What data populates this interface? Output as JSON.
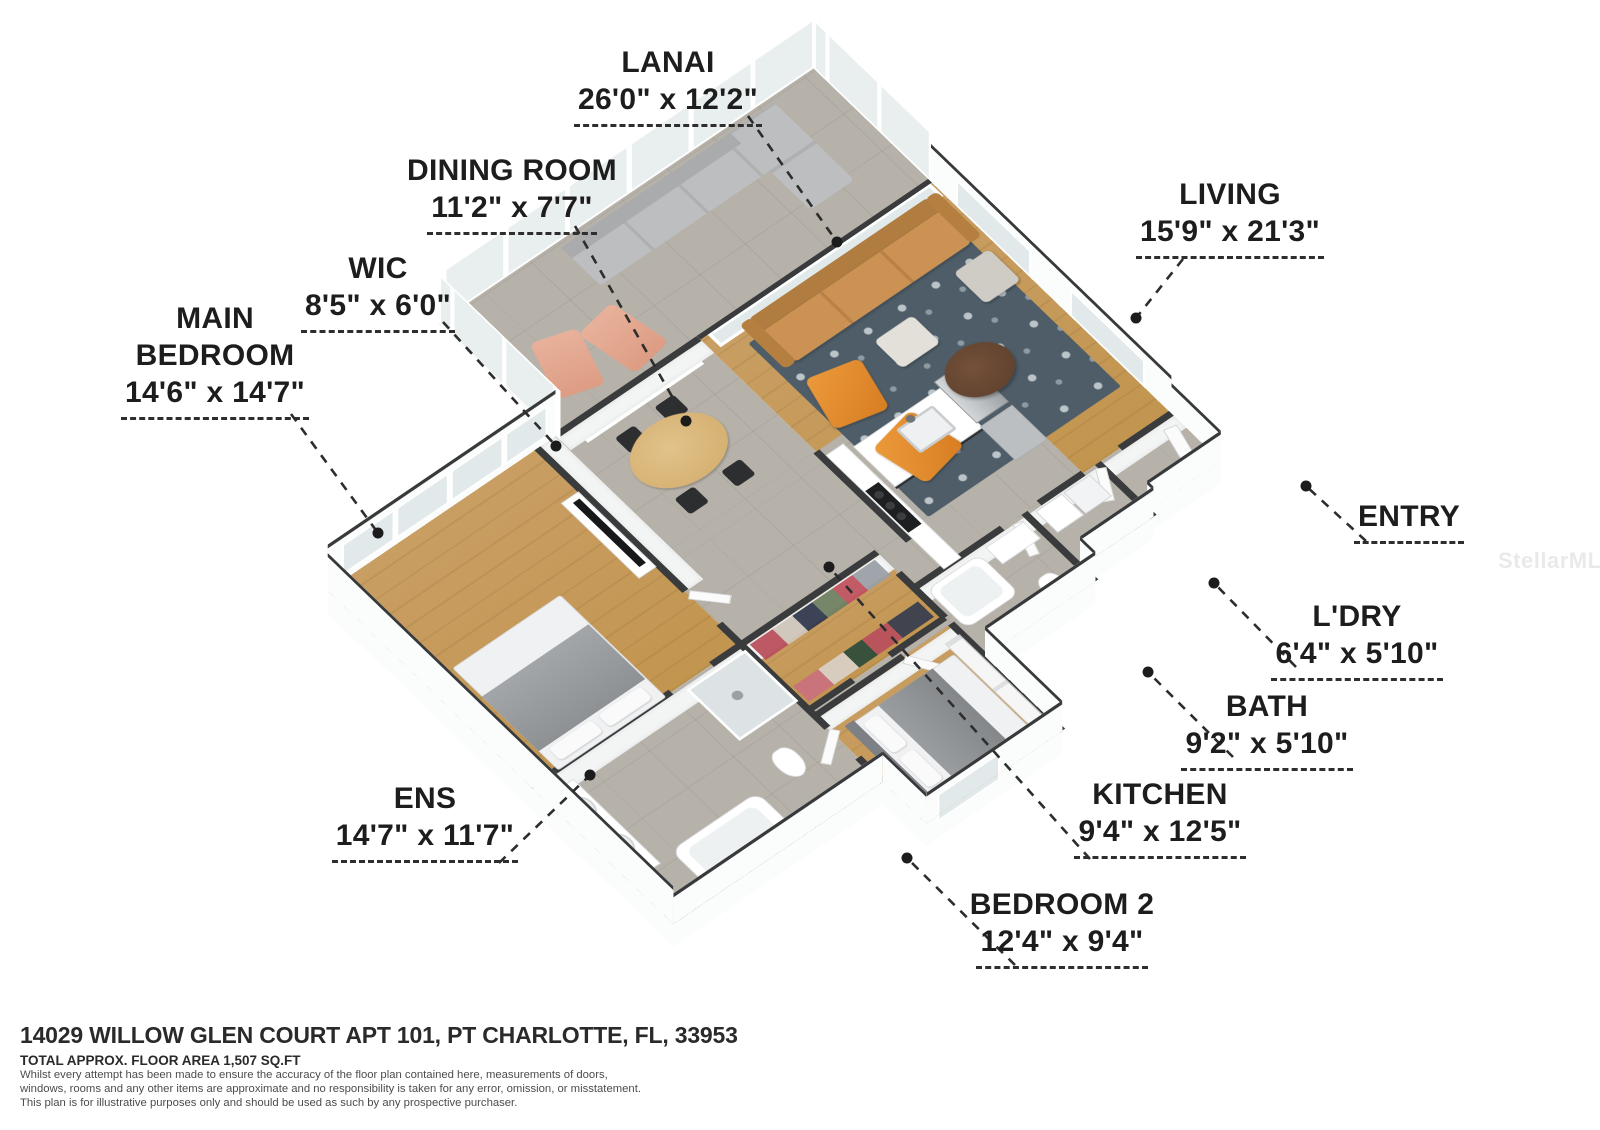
{
  "rooms": [
    {
      "name": "LANAI",
      "dims": "26'0\" x 12'2\""
    },
    {
      "name": "DINING ROOM",
      "dims": "11'2\" x 7'7\""
    },
    {
      "name": "WIC",
      "dims": "8'5\" x 6'0\""
    },
    {
      "name": "MAIN BEDROOM",
      "dims": "14'6\" x 14'7\""
    },
    {
      "name": "LIVING",
      "dims": "15'9\" x 21'3\""
    },
    {
      "name": "ENTRY",
      "dims": ""
    },
    {
      "name": "L'DRY",
      "dims": "6'4\" x 5'10\""
    },
    {
      "name": "BATH",
      "dims": "9'2\" x 5'10\""
    },
    {
      "name": "KITCHEN",
      "dims": "9'4\" x 12'5\""
    },
    {
      "name": "BEDROOM 2",
      "dims": "12'4\" x 9'4\""
    },
    {
      "name": "ENS",
      "dims": "14'7\" x 11'7\""
    }
  ],
  "footer": {
    "address": "14029 WILLOW GLEN COURT APT 101, PT CHARLOTTE, FL, 33953",
    "area": "TOTAL APPROX. FLOOR AREA 1,507 SQ.FT",
    "disclaimer": [
      "Whilst every attempt has been made to ensure the accuracy of the floor plan contained here, measurements of doors,",
      "windows, rooms and any other items are approximate and no responsibility is taken for any error, omission, or misstatement.",
      "This plan is for illustrative purposes only and should be used as such by any prospective purchaser."
    ]
  },
  "watermark": "StellarMLS",
  "palette": {
    "wood_floor": "#c59a5c",
    "tile_floor": "#b6b1a9",
    "wall_cap": "#393b3d",
    "wall_face": "#fbfcfc",
    "rug": "#4e5d68",
    "sofa_tan": "#c78e4f",
    "armchair_orange": "#e08a2e",
    "lanai_sofa_gray": "#b7b9bb",
    "lounger_salmon": "#e2a58e",
    "leader_line": "#2d2d2d"
  }
}
